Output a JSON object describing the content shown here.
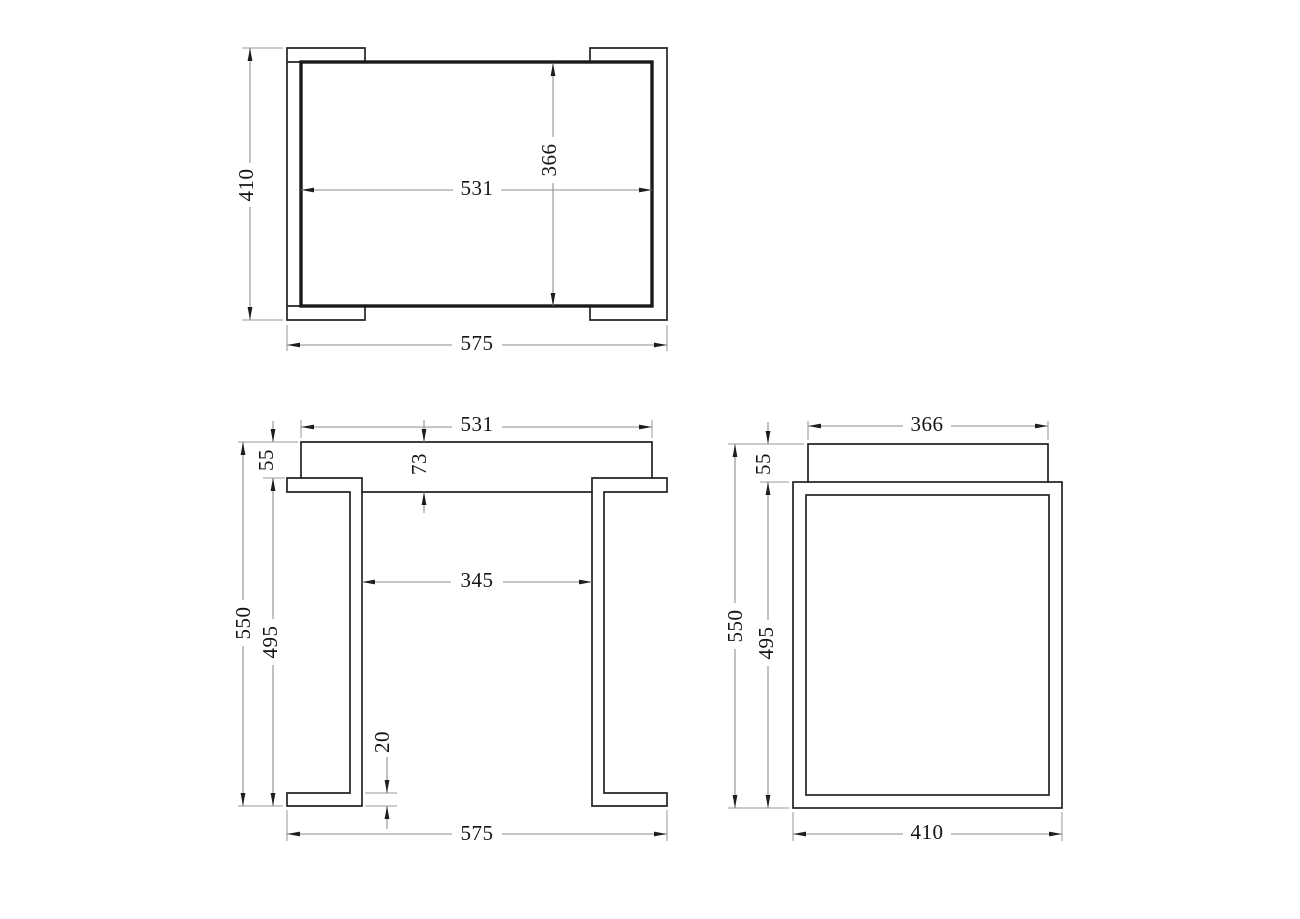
{
  "drawing": {
    "kind": "three-view furniture dimension drawing",
    "views": {
      "top": {
        "overall_depth": "410",
        "tabletop_length": "531",
        "tabletop_depth": "366",
        "overall_width": "575"
      },
      "front": {
        "tabletop_length": "531",
        "tabletop_overhang": "55",
        "tabletop_thickness": "73",
        "leg_inner_gap": "345",
        "overall_height": "550",
        "leg_height": "495",
        "foot_thickness": "20",
        "overall_width": "575"
      },
      "side": {
        "tabletop_depth": "366",
        "tabletop_overhang": "55",
        "overall_height": "550",
        "leg_height": "495",
        "overall_depth": "410"
      }
    },
    "colors": {
      "geometry": "#232323",
      "dimension_lines": "#8e8e8e",
      "text": "#141414",
      "background": "#ffffff"
    }
  }
}
